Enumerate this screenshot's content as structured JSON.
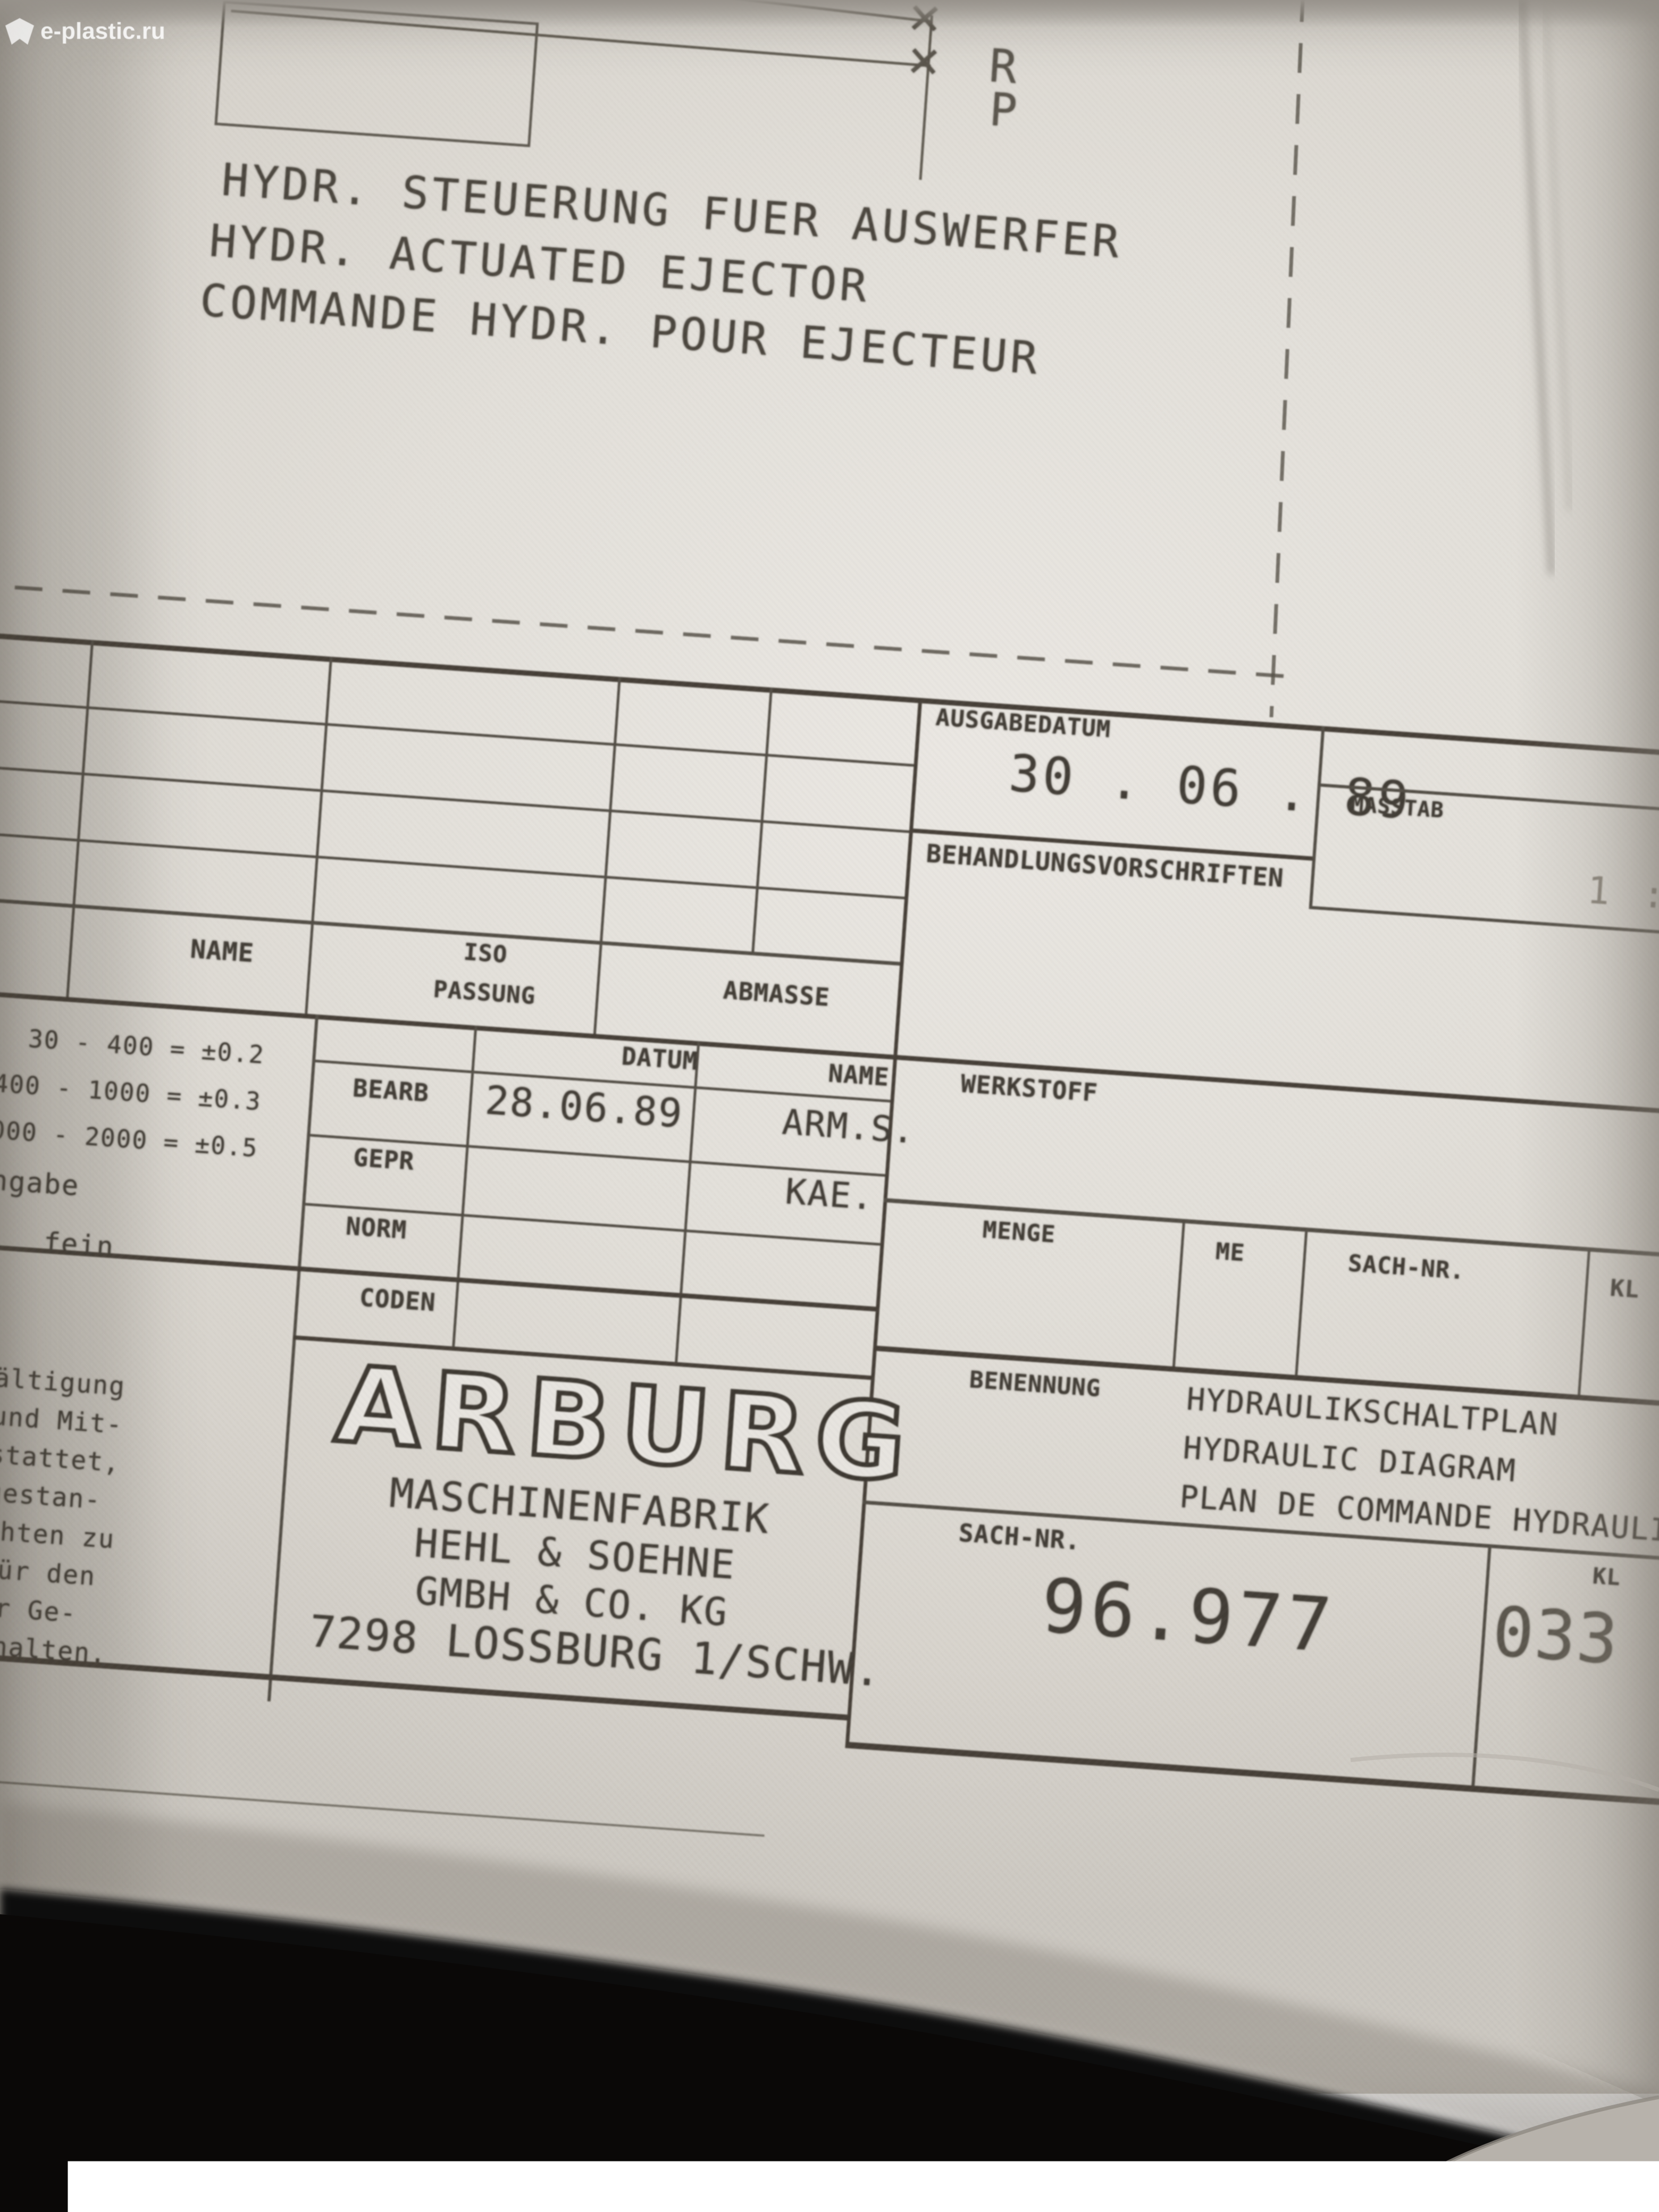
{
  "photo": {
    "watermark": "e-plastic.ru"
  },
  "schematic": {
    "title_de": "HYDR. STEUERUNG FUER AUSWERFER",
    "title_en": "HYDR. ACTUATED EJECTOR",
    "title_fr": "COMMANDE HYDR. POUR EJECTEUR",
    "port_r": "R",
    "port_p": "P",
    "closed_port_symbol": "✕"
  },
  "titleblock": {
    "ausgabedatum_label": "AUSGABEDATUM",
    "ausgabedatum": "30 . 06 . 89",
    "masstab_label": "MASSTAB",
    "masstab": "1 : 1",
    "behandlung_label": "BEHANDLUNGSVORSCHRIFTEN",
    "name_col": "NAME",
    "iso_line1": "ISO",
    "iso_line2": "PASSUNG",
    "abmasse": "ABMASSE",
    "tol": {
      "l1": "30 - 400 = ±0.2",
      "l2": "400 - 1000 = ±0.3",
      "l3": "1000 - 2000 = ±0.5",
      "w1": "angabe",
      "w2": "fein"
    },
    "datum_hdr": "DATUM",
    "name_hdr": "NAME",
    "bearb": "BEARB",
    "bearb_datum": "28.06.89",
    "bearb_name": "ARM.S.",
    "gepr": "GEPR",
    "gepr_name": "KAE.",
    "norm": "NORM",
    "coden": "CODEN",
    "werkstoff": "WERKSTOFF",
    "menge": "MENGE",
    "me": "ME",
    "sachnr_col": "SACH-NR.",
    "kl_col": "KL",
    "benennung_label": "BENENNUNG",
    "ben1": "HYDRAULIKSCHALTPLAN",
    "ben2": "HYDRAULIC DIAGRAM",
    "ben3": "PLAN DE COMMANDE HYDRAULIQUE",
    "sachnr_label": "SACH-NR.",
    "sachnr": "96.977",
    "kl_label": "KL",
    "kl": "033",
    "company": {
      "logo": "ARBURG",
      "l1": "MASCHINENFABRIK",
      "l2": "HEHL & SOEHNE",
      "l3": "GMBH & CO. KG",
      "l4": "7298 LOSSBURG 1/SCHW."
    },
    "note": {
      "l1": "rvielfältigung",
      "l2": "rtung und Mit-",
      "l3": "cht gestattet,",
      "l4": "ich zugestan-",
      "l5": "erpflichten zu",
      "l6": "echte für den",
      "l7": "ung  oder Ge-",
      "l8": "n vorbehalten."
    }
  },
  "colors": {
    "ink": "#423d36",
    "line": "#524d45",
    "paper": "#e2dfd9",
    "background_dark": "#0d0b09",
    "faint_value": "#8a847a"
  }
}
